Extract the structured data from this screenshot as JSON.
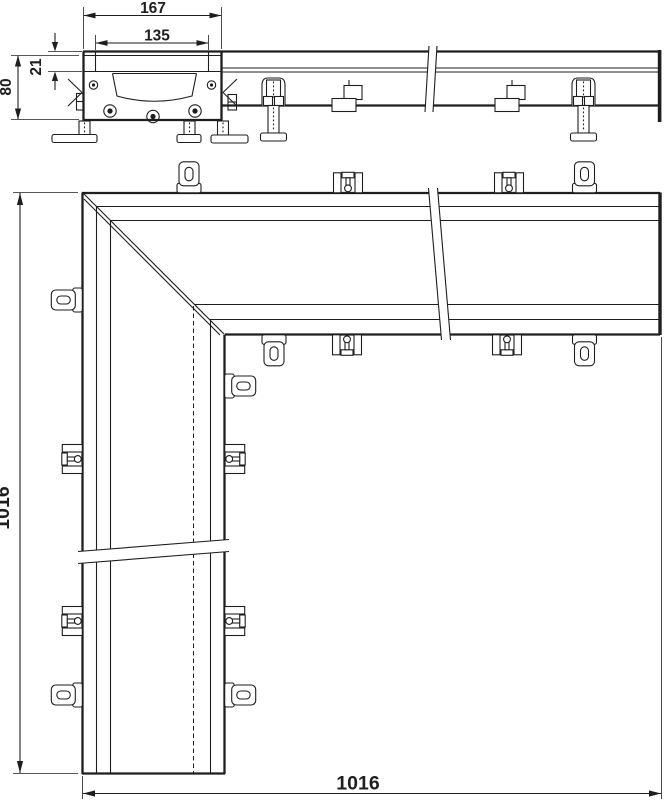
{
  "drawing": {
    "title": "corner-drainage-channel-technical-drawing",
    "views": [
      "cross-section",
      "side-elevation",
      "plan-corner"
    ],
    "dimensions": {
      "overall_width": "167",
      "grate_width": "135",
      "grate_depth": "21",
      "body_height": "80",
      "length_left": "1016",
      "length_bottom": "1016"
    },
    "colors": {
      "line": "#1e1e1e",
      "background": "#ffffff"
    }
  }
}
